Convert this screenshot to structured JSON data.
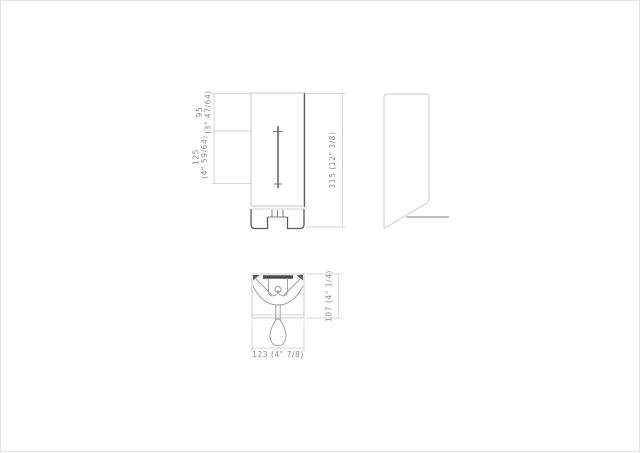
{
  "colors": {
    "background": "#ffffff",
    "line_light": "#c9c9c9",
    "line_medium": "#9a9a9a",
    "line_dark": "#5a5a5a",
    "dim_text": "#8c8c8c"
  },
  "dimensions": {
    "spout_offset": {
      "mm": "95",
      "inch": "(3\" 47/64)"
    },
    "window_height": {
      "mm": "125",
      "inch": "(4\" 59/64)"
    },
    "overall_height": {
      "label": "315 (12\" 3/8)"
    },
    "depth": {
      "label": "107 (4\" 1/4)"
    },
    "width": {
      "label": "123 (4\" 7/8)"
    }
  }
}
